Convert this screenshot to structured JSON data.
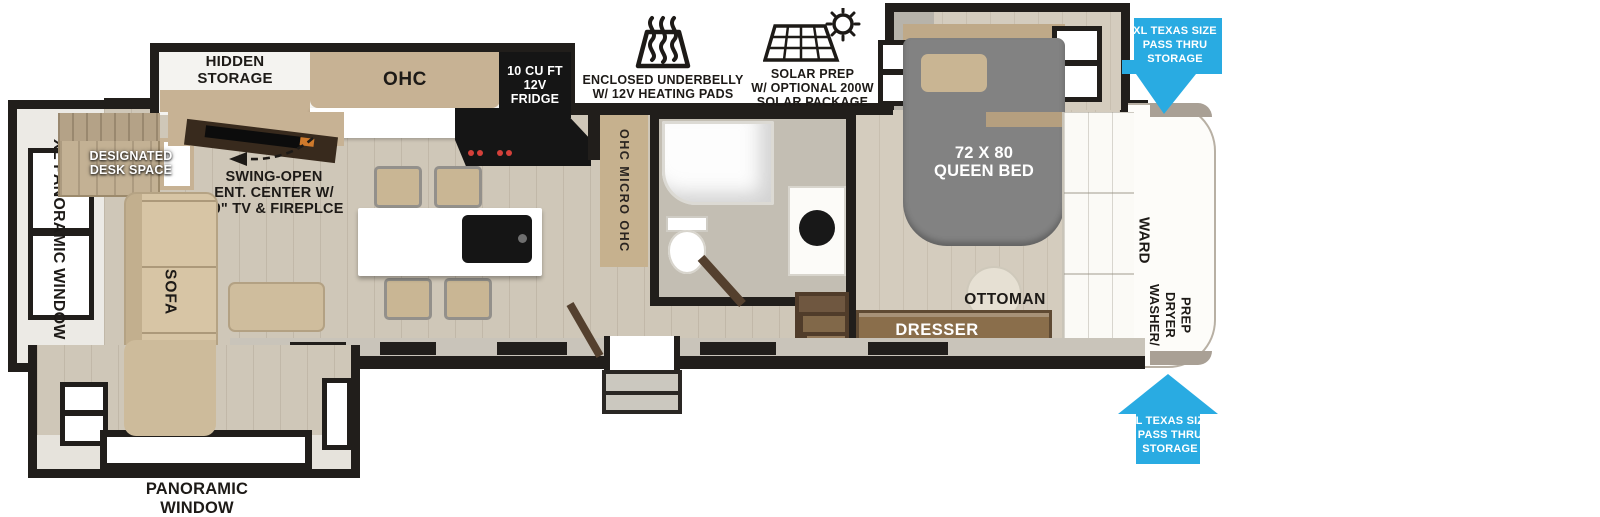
{
  "labels": {
    "hidden_storage": "HIDDEN\nSTORAGE",
    "ohc": "OHC",
    "fridge": "10 CU FT\n12V\nFRIDGE",
    "queen_bed": "72 X 80\nQUEEN BED",
    "ward": "WARD",
    "washer_dryer_prep": "WASHER/\nDRYER\nPREP",
    "dresser": "DRESSER",
    "ottoman": "OTTOMAN",
    "ohc_micro": "OHC MICRO OHC",
    "desk": "DESIGNATED\nDESK SPACE",
    "ent_center": "SWING-OPEN\nENT. CENTER W/\n50\" TV & FIREPLCE",
    "sofa_left": "SOFA",
    "sofa_bottom": "SOFA",
    "xl_panoramic_window": "XL PANORAMIC WINDOW",
    "panoramic_window": "PANORAMIC\nWINDOW"
  },
  "features": {
    "underbelly": {
      "icon": "heated-underbelly-icon",
      "label": "ENCLOSED UNDERBELLY\nW/ 12V HEATING PADS"
    },
    "solar": {
      "icon": "solar-prep-icon",
      "label": "SOLAR PREP\nW/ OPTIONAL 200W\nSOLAR PACKAGE"
    }
  },
  "callouts": {
    "pass_thru_top": "XL TEXAS SIZE\nPASS THRU\nSTORAGE",
    "pass_thru_bottom": "XL TEXAS SIZE\nPASS THRU\nSTORAGE"
  },
  "colors": {
    "wall": "#211e1b",
    "floor": "#cfc7b8",
    "floor_bedroom": "#d4ccbe",
    "cabinet": "#c7b294",
    "sofa": "#d7c5a5",
    "bed": "#828282",
    "counter": "#ffffff",
    "appliance": "#151515",
    "door": "#54402e",
    "arrow_blue": "#29abe2",
    "trim_gray": "#a9a095"
  }
}
